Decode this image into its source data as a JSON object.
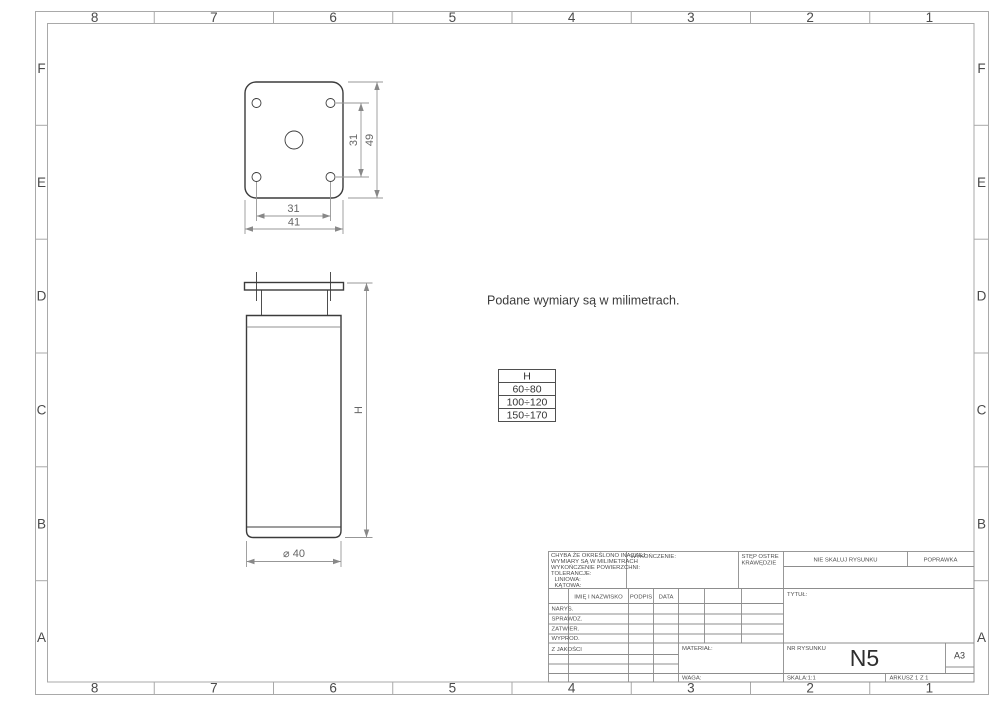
{
  "sheet": {
    "zone_columns": [
      "8",
      "7",
      "6",
      "5",
      "4",
      "3",
      "2",
      "1"
    ],
    "zone_rows": [
      "F",
      "E",
      "D",
      "C",
      "B",
      "A"
    ]
  },
  "annotations": {
    "units_note": "Podane wymiary są w milimetrach."
  },
  "dimensions": {
    "hole_spacing_vertical": "31",
    "plate_height": "49",
    "hole_spacing_horizontal": "31",
    "plate_width": "41",
    "leg_height": "H",
    "leg_diameter": "⌀ 40"
  },
  "h_table": {
    "header": "H",
    "rows": [
      "60÷80",
      "100÷120",
      "150÷170"
    ]
  },
  "title_block": {
    "tolerance_note_lines": [
      "CHYBA ŻE OKREŚLONO INACZEJ:",
      "WYMIARY SĄ W MILIMETRACH",
      "WYKOŃCZENIE POWIERZCHNI:",
      "TOLERANCJE:",
      "LINIOWA:",
      "KĄTOWA:"
    ],
    "finish_label": "WYKOŃCZENIE:",
    "deburr_line1": "STĘP OSTRE",
    "deburr_line2": "KRAWĘDZIE",
    "do_not_scale": "NIE SKALUJ RYSUNKU",
    "revision_label": "POPRAWKA",
    "col_headers": {
      "name": "IMIĘ I NAZWISKO",
      "signature": "PODPIS",
      "date": "DATA"
    },
    "row_labels": [
      "NARYS.",
      "SPRAWDZ.",
      "ZATWIER.",
      "WYPROD.",
      "Z JAKOŚCI"
    ],
    "title_label": "TYTUŁ:",
    "material_label": "MATERIAŁ:",
    "weight_label": "WAGA:",
    "drawing_no_label": "NR RYSUNKU",
    "drawing_number": "N5",
    "paper_size": "A3",
    "scale": "SKALA:1:1",
    "sheet_label": "ARKUSZ 1 Z 1"
  }
}
